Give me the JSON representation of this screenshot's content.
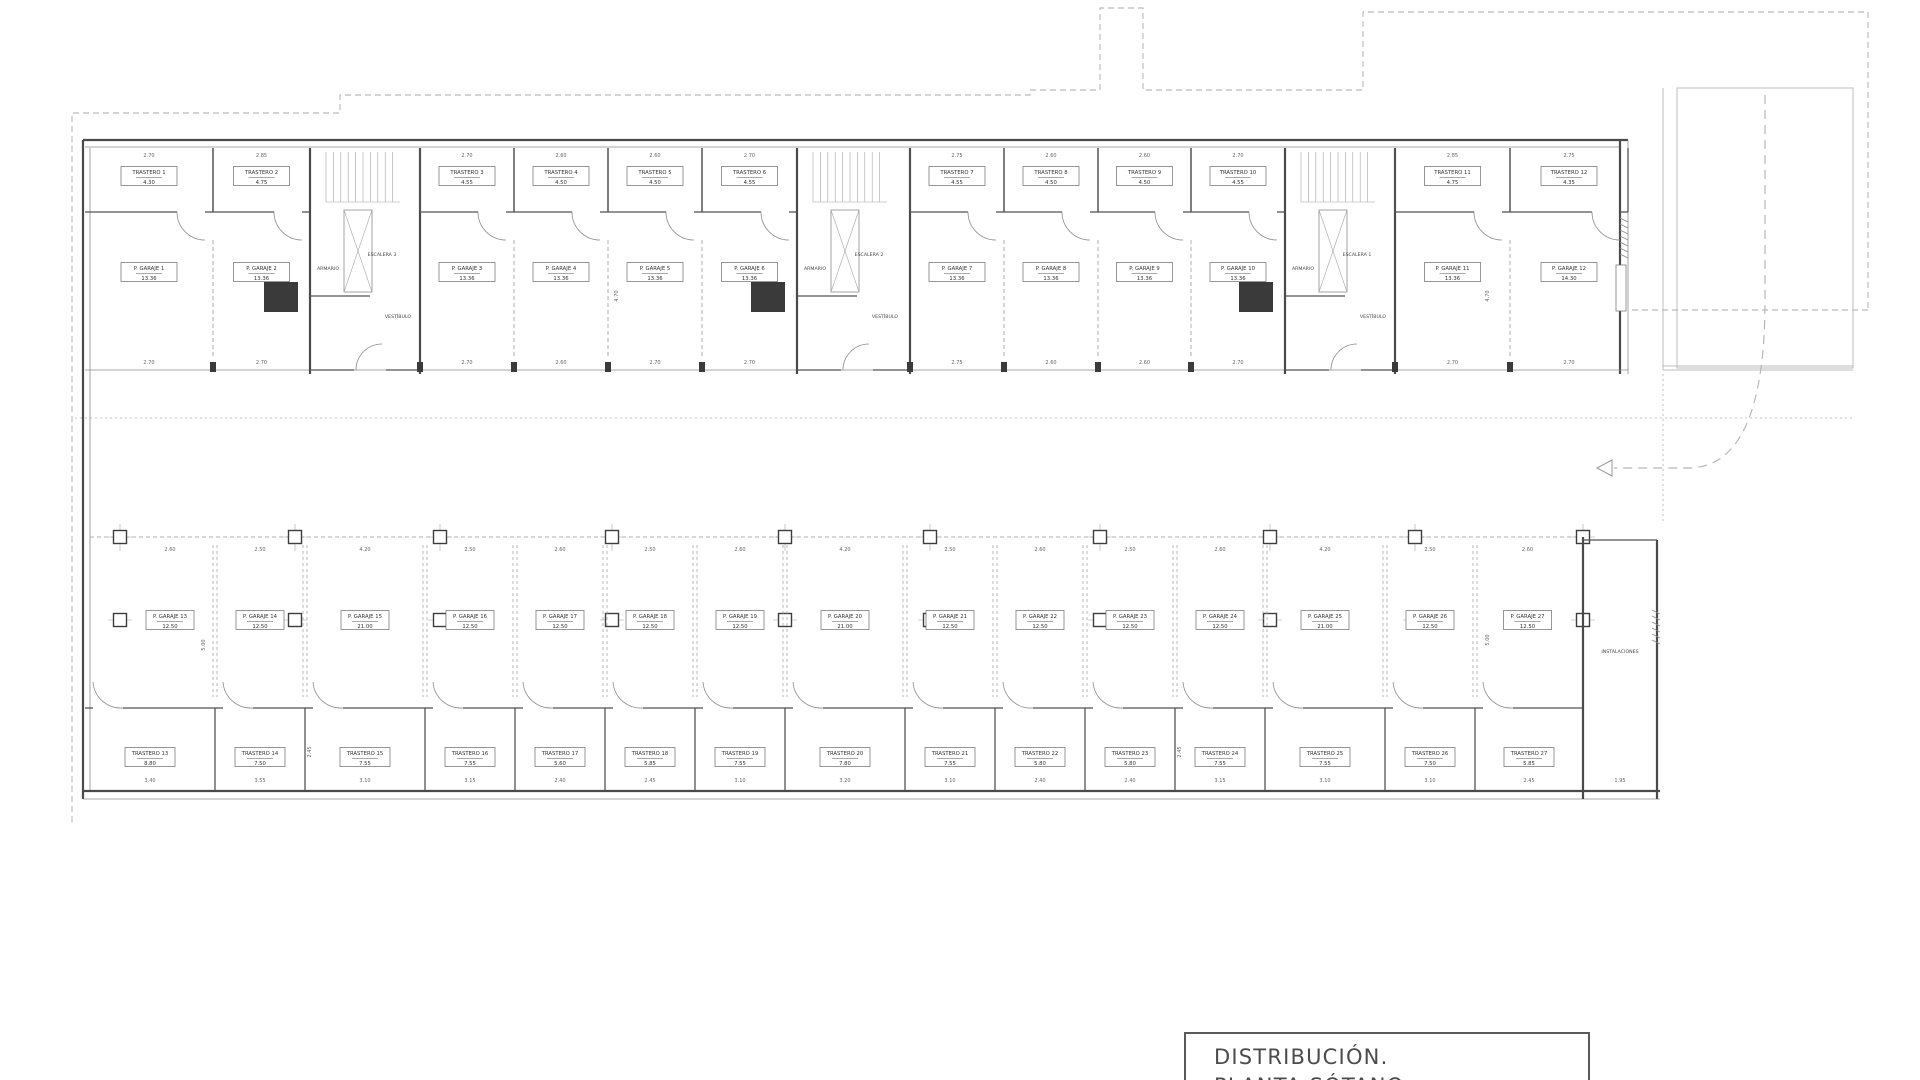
{
  "title_block": {
    "line1": "DISTRIBUCIÓN.",
    "line2": "PLANTA SÓTANO"
  },
  "labels": {
    "armario": "ARMARIO",
    "vestibulo": "VESTÍBULO",
    "instalaciones": "INSTALACIONES"
  },
  "cores": [
    {
      "name": "ESCALERA 3"
    },
    {
      "name": "ESCALERA 2"
    },
    {
      "name": "ESCALERA 1"
    }
  ],
  "top_trasteros": [
    {
      "name": "TRASTERO 1",
      "area": "4.30",
      "dim": "2.70"
    },
    {
      "name": "TRASTERO 2",
      "area": "4.75",
      "dim": "2.85"
    },
    {
      "name": "TRASTERO 3",
      "area": "4.55",
      "dim": "2.70"
    },
    {
      "name": "TRASTERO 4",
      "area": "4.50",
      "dim": "2.60"
    },
    {
      "name": "TRASTERO 5",
      "area": "4.50",
      "dim": "2.60"
    },
    {
      "name": "TRASTERO 6",
      "area": "4.55",
      "dim": "2.70"
    },
    {
      "name": "TRASTERO 7",
      "area": "4.55",
      "dim": "2.75"
    },
    {
      "name": "TRASTERO 8",
      "area": "4.50",
      "dim": "2.60"
    },
    {
      "name": "TRASTERO 9",
      "area": "4.50",
      "dim": "2.60"
    },
    {
      "name": "TRASTERO 10",
      "area": "4.55",
      "dim": "2.70"
    },
    {
      "name": "TRASTERO 11",
      "area": "4.75",
      "dim": "2.85"
    },
    {
      "name": "TRASTERO 12",
      "area": "4.35",
      "dim": "2.75"
    }
  ],
  "top_garajes": [
    {
      "name": "P. GARAJE 1",
      "area": "13.36",
      "dim": "2.70"
    },
    {
      "name": "P. GARAJE 2",
      "area": "13.36",
      "dim": "2.70"
    },
    {
      "name": "P. GARAJE 3",
      "area": "13.36",
      "dim": "2.70"
    },
    {
      "name": "P. GARAJE 4",
      "area": "13.36",
      "dim": "2.60"
    },
    {
      "name": "P. GARAJE 5",
      "area": "13.36",
      "dim": "2.70"
    },
    {
      "name": "P. GARAJE 6",
      "area": "13.36",
      "dim": "2.70"
    },
    {
      "name": "P. GARAJE 7",
      "area": "13.36",
      "dim": "2.75"
    },
    {
      "name": "P. GARAJE 8",
      "area": "13.36",
      "dim": "2.60"
    },
    {
      "name": "P. GARAJE 9",
      "area": "13.36",
      "dim": "2.60"
    },
    {
      "name": "P. GARAJE 10",
      "area": "13.36",
      "dim": "2.70"
    },
    {
      "name": "P. GARAJE 11",
      "area": "13.36",
      "dim": "2.70"
    },
    {
      "name": "P. GARAJE 12",
      "area": "14.30",
      "dim": "2.70"
    }
  ],
  "mid_garajes": [
    {
      "name": "P. GARAJE 13",
      "area": "12.50",
      "dim": "2.60"
    },
    {
      "name": "P. GARAJE 14",
      "area": "12.50",
      "dim": "2.50"
    },
    {
      "name": "P. GARAJE 15",
      "area": "21.00",
      "dim": "4.20"
    },
    {
      "name": "P. GARAJE 16",
      "area": "12.50",
      "dim": "2.50"
    },
    {
      "name": "P. GARAJE 17",
      "area": "12.50",
      "dim": "2.60"
    },
    {
      "name": "P. GARAJE 18",
      "area": "12.50",
      "dim": "2.50"
    },
    {
      "name": "P. GARAJE 19",
      "area": "12.50",
      "dim": "2.60"
    },
    {
      "name": "P. GARAJE 20",
      "area": "21.00",
      "dim": "4.20"
    },
    {
      "name": "P. GARAJE 21",
      "area": "12.50",
      "dim": "2.50"
    },
    {
      "name": "P. GARAJE 22",
      "area": "12.50",
      "dim": "2.60"
    },
    {
      "name": "P. GARAJE 23",
      "area": "12.50",
      "dim": "2.50"
    },
    {
      "name": "P. GARAJE 24",
      "area": "12.50",
      "dim": "2.60"
    },
    {
      "name": "P. GARAJE 25",
      "area": "21.00",
      "dim": "4.20"
    },
    {
      "name": "P. GARAJE 26",
      "area": "12.50",
      "dim": "2.50"
    },
    {
      "name": "P. GARAJE 27",
      "area": "12.50",
      "dim": "2.60"
    }
  ],
  "bottom_trasteros": [
    {
      "name": "TRASTERO 13",
      "area": "8.80",
      "dim": "3.40"
    },
    {
      "name": "TRASTERO 14",
      "area": "7.50",
      "dim": "3.55"
    },
    {
      "name": "TRASTERO 15",
      "area": "7.55",
      "dim": "3.10"
    },
    {
      "name": "TRASTERO 16",
      "area": "7.55",
      "dim": "3.15"
    },
    {
      "name": "TRASTERO 17",
      "area": "5.60",
      "dim": "2.40"
    },
    {
      "name": "TRASTERO 18",
      "area": "5.85",
      "dim": "2.45"
    },
    {
      "name": "TRASTERO 19",
      "area": "7.55",
      "dim": "3.10"
    },
    {
      "name": "TRASTERO 20",
      "area": "7.80",
      "dim": "3.20"
    },
    {
      "name": "TRASTERO 21",
      "area": "7.55",
      "dim": "3.10"
    },
    {
      "name": "TRASTERO 22",
      "area": "5.80",
      "dim": "2.40"
    },
    {
      "name": "TRASTERO 23",
      "area": "5.80",
      "dim": "2.40"
    },
    {
      "name": "TRASTERO 24",
      "area": "7.55",
      "dim": "3.15"
    },
    {
      "name": "TRASTERO 25",
      "area": "7.55",
      "dim": "3.10"
    },
    {
      "name": "TRASTERO 26",
      "area": "7.50",
      "dim": "3.10"
    },
    {
      "name": "TRASTERO 27",
      "area": "5.85",
      "dim": "2.45"
    }
  ],
  "extra_dims": {
    "bay_depth": "4.70",
    "stall_depth": "5.00",
    "room_depth": "2.45",
    "inst_width": "1.95"
  }
}
